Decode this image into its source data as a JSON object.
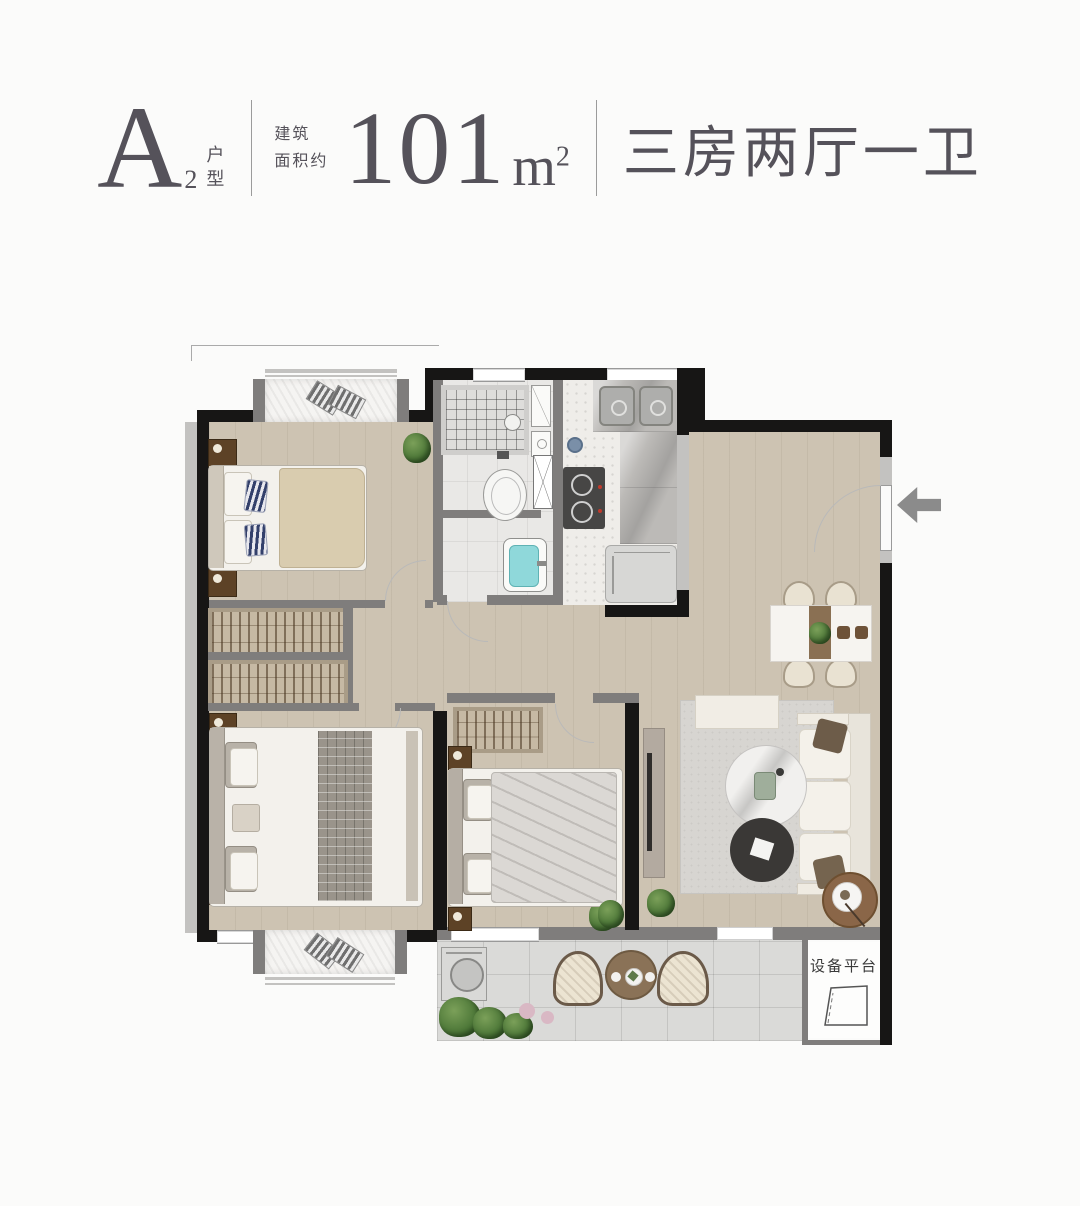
{
  "header": {
    "unit_letter": "A",
    "unit_number": "2",
    "unit_type_label": "户型",
    "area_label_line1": "建筑",
    "area_label_line2": "面积约",
    "area_value": "101",
    "area_unit": "m",
    "area_unit_exponent": "2",
    "layout_description": "三房两厅一卫"
  },
  "plan": {
    "equipment_platform_label": "设备平台"
  },
  "colors": {
    "text": "#55525a",
    "divider": "#9b9b9b",
    "wall-black": "#171615",
    "wall-gray": "#7f7d7c",
    "wall-light": "#c3c2c0",
    "floor-wood": "#cdc3b2",
    "floor-tile": "#e9e8e6",
    "floor-terrazzo": "#efede9",
    "floor-balcony": "#dadad8",
    "counter-marble": "#bcbab7",
    "wardrobe": "#c6b9a4",
    "rug": "#d7d5d1",
    "basin-teal": "#8fd8da",
    "arrow-gray": "#8b8b8b"
  }
}
